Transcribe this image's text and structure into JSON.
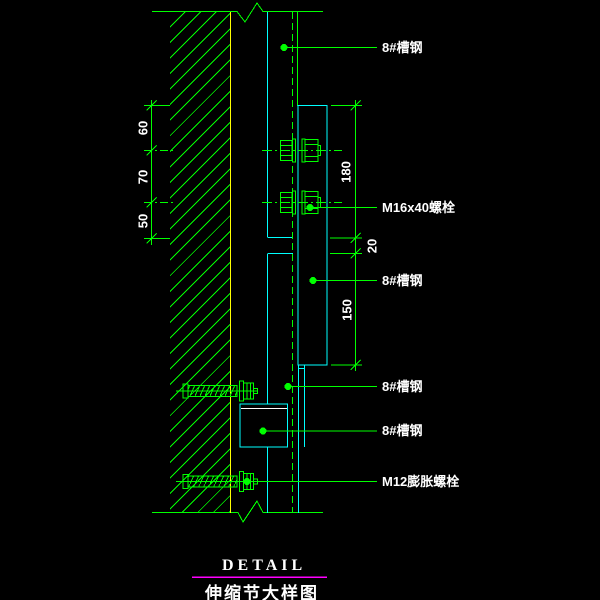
{
  "drawing": {
    "type": "cad-detail",
    "title_en": "DETAIL",
    "title_zh": "伸缩节大样图",
    "leader_labels": [
      {
        "text": "8#槽钢"
      },
      {
        "text": "M16x40螺栓"
      },
      {
        "text": "8#槽钢"
      },
      {
        "text": "8#槽钢"
      },
      {
        "text": "8#槽钢"
      },
      {
        "text": "M12膨胀螺栓"
      }
    ],
    "dimensions_left": [
      {
        "value": "60"
      },
      {
        "value": "70"
      },
      {
        "value": "50"
      }
    ],
    "dimensions_right": [
      {
        "value": "180"
      },
      {
        "value": "20"
      },
      {
        "value": "150"
      }
    ],
    "colors": {
      "line_green": "#00ff00",
      "line_cyan": "#00ffff",
      "wall_face_yellow": "#ffff00",
      "underline_magenta": "#ff00ff",
      "text_white": "#ffffff",
      "background": "#000000"
    }
  }
}
